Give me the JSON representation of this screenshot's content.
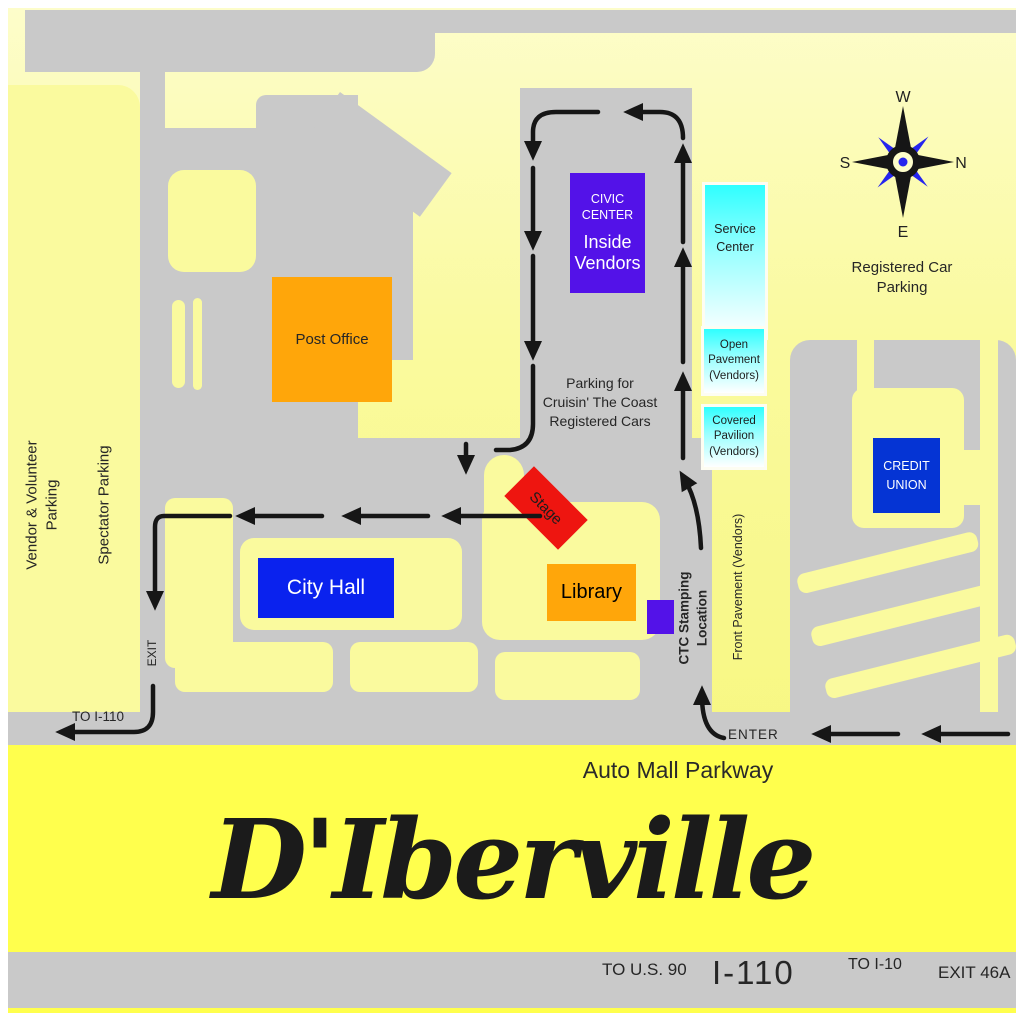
{
  "compass": {
    "w": "W",
    "n": "N",
    "e": "E",
    "s": "S"
  },
  "lots": {
    "vendor_volunteer_1": "Vendor & Volunteer",
    "vendor_volunteer_2": "Parking",
    "spectator": "Spectator Parking",
    "registered_1": "Registered Car",
    "registered_2": "Parking",
    "central_1": "Parking for",
    "central_2": "Cruisin' The Coast",
    "central_3": "Registered Cars"
  },
  "buildings": {
    "post_office": "Post Office",
    "civic_1": "CIVIC",
    "civic_2": "CENTER",
    "civic_3": "Inside",
    "civic_4": "Vendors",
    "service_1": "Service",
    "service_2": "Center",
    "open_1": "Open",
    "open_2": "Pavement",
    "open_3": "(Vendors)",
    "covered_1": "Covered",
    "covered_2": "Pavilion",
    "covered_3": "(Vendors)",
    "city_hall": "City Hall",
    "library": "Library",
    "credit_1": "CREDIT",
    "credit_2": "UNION",
    "stage": "Stage"
  },
  "routes": {
    "exit": "EXIT",
    "to_i110": "TO I-110",
    "enter": "ENTER",
    "ctc_1": "CTC Stamping",
    "ctc_2": "Location",
    "front_pavement": "Front Pavement (Vendors)"
  },
  "bottom": {
    "auto_mall": "Auto Mall Parkway",
    "city_name": "D'Iberville",
    "to_us90": "TO U.S. 90",
    "i110": "I-110",
    "to_i10": "TO I-10",
    "exit_46a": "EXIT 46A"
  },
  "colors": {
    "road_gray": "#C9C9C9",
    "lot_yellow": "#FAFA9E",
    "band_yellow": "#FFFF4D",
    "civic_purple": "#5312E8",
    "city_hall_blue": "#0A22EE",
    "credit_union_blue": "#0534D4",
    "building_orange": "#FFA60A",
    "stage_red": "#EE1510",
    "vendor_cyan": "#2FFFFF",
    "compass_blue": "#2525EE"
  }
}
